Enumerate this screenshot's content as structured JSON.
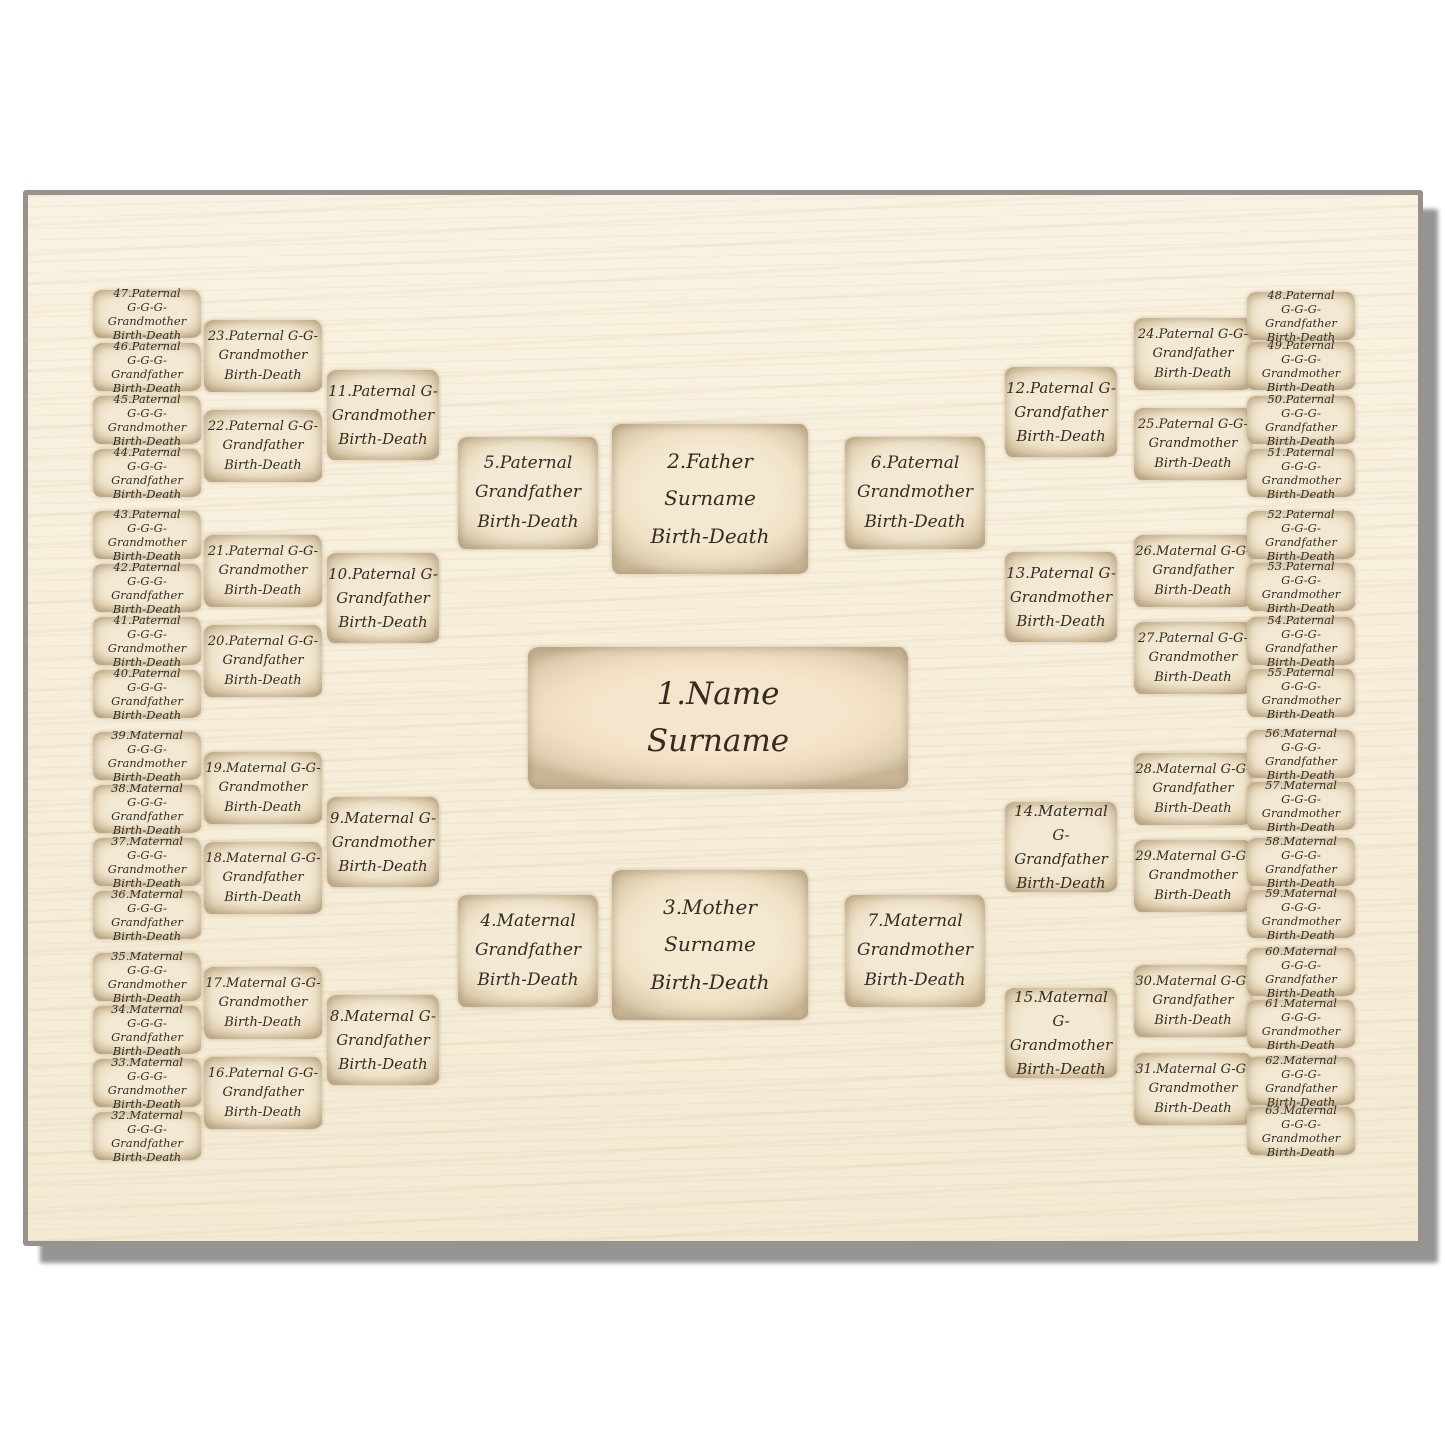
{
  "product": {
    "description": "6-generation genealogy family tree pedigree template printed on a wooden board",
    "colors": {
      "page_background": "#ffffff",
      "board_surface": "#f7efdc",
      "board_edge": "#97928c",
      "board_shadow": "#8f8f8f",
      "parchment_fill": "#f2e9d4",
      "parchment_edge": "#c8b696",
      "text": "#342c21"
    }
  },
  "boxes": {
    "1": {
      "l1": "1.Name",
      "l2": "Surname"
    },
    "2": {
      "l1": "2.Father",
      "l2": "Surname",
      "l3": "Birth-Death"
    },
    "3": {
      "l1": "3.Mother",
      "l2": "Surname",
      "l3": "Birth-Death"
    },
    "4": {
      "l1": "4.Maternal",
      "l2": "Grandfather",
      "l3": "Birth-Death"
    },
    "5": {
      "l1": "5.Paternal",
      "l2": "Grandfather",
      "l3": "Birth-Death"
    },
    "6": {
      "l1": "6.Paternal",
      "l2": "Grandmother",
      "l3": "Birth-Death"
    },
    "7": {
      "l1": "7.Maternal",
      "l2": "Grandmother",
      "l3": "Birth-Death"
    },
    "8": {
      "l1": "8.Maternal G-",
      "l2": "Grandfather",
      "l3": "Birth-Death"
    },
    "9": {
      "l1": "9.Maternal G-",
      "l2": "Grandmother",
      "l3": "Birth-Death"
    },
    "10": {
      "l1": "10.Paternal G-",
      "l2": "Grandfather",
      "l3": "Birth-Death"
    },
    "11": {
      "l1": "11.Paternal G-",
      "l2": "Grandmother",
      "l3": "Birth-Death"
    },
    "12": {
      "l1": "12.Paternal G-",
      "l2": "Grandfather",
      "l3": "Birth-Death"
    },
    "13": {
      "l1": "13.Paternal G-",
      "l2": "Grandmother",
      "l3": "Birth-Death"
    },
    "14": {
      "l1": "14.Maternal G-",
      "l2": "Grandfather",
      "l3": "Birth-Death"
    },
    "15": {
      "l1": "15.Maternal G-",
      "l2": "Grandmother",
      "l3": "Birth-Death"
    },
    "16": {
      "l1": "16.Paternal G-G-",
      "l2": "Grandfather",
      "l3": "Birth-Death"
    },
    "17": {
      "l1": "17.Maternal G-G-",
      "l2": "Grandmother",
      "l3": "Birth-Death"
    },
    "18": {
      "l1": "18.Maternal G-G-",
      "l2": "Grandfather",
      "l3": "Birth-Death"
    },
    "19": {
      "l1": "19.Maternal G-G-",
      "l2": "Grandmother",
      "l3": "Birth-Death"
    },
    "20": {
      "l1": "20.Paternal G-G-",
      "l2": "Grandfather",
      "l3": "Birth-Death"
    },
    "21": {
      "l1": "21.Paternal G-G-",
      "l2": "Grandmother",
      "l3": "Birth-Death"
    },
    "22": {
      "l1": "22.Paternal G-G-",
      "l2": "Grandfather",
      "l3": "Birth-Death"
    },
    "23": {
      "l1": "23.Paternal G-G-",
      "l2": "Grandmother",
      "l3": "Birth-Death"
    },
    "24": {
      "l1": "24.Paternal G-G-",
      "l2": "Grandfather",
      "l3": "Birth-Death"
    },
    "25": {
      "l1": "25.Paternal G-G-",
      "l2": "Grandmother",
      "l3": "Birth-Death"
    },
    "26": {
      "l1": "26.Maternal G-G-",
      "l2": "Grandfather",
      "l3": "Birth-Death"
    },
    "27": {
      "l1": "27.Paternal G-G-",
      "l2": "Grandmother",
      "l3": "Birth-Death"
    },
    "28": {
      "l1": "28.Maternal G-G-",
      "l2": "Grandfather",
      "l3": "Birth-Death"
    },
    "29": {
      "l1": "29.Maternal G-G-",
      "l2": "Grandmother",
      "l3": "Birth-Death"
    },
    "30": {
      "l1": "30.Maternal G-G-",
      "l2": "Grandfather",
      "l3": "Birth-Death"
    },
    "31": {
      "l1": "31.Maternal G-G-",
      "l2": "Grandmother",
      "l3": "Birth-Death"
    },
    "32": {
      "l1": "32.Maternal",
      "l2": "G-G-G-Grandfather",
      "l3": "Birth-Death"
    },
    "33": {
      "l1": "33.Maternal",
      "l2": "G-G-G-Grandmother",
      "l3": "Birth-Death"
    },
    "34": {
      "l1": "34.Maternal",
      "l2": "G-G-G-Grandfather",
      "l3": "Birth-Death"
    },
    "35": {
      "l1": "35.Maternal",
      "l2": "G-G-G-Grandmother",
      "l3": "Birth-Death"
    },
    "36": {
      "l1": "36.Maternal",
      "l2": "G-G-G-Grandfather",
      "l3": "Birth-Death"
    },
    "37": {
      "l1": "37.Maternal",
      "l2": "G-G-G-Grandmother",
      "l3": "Birth-Death"
    },
    "38": {
      "l1": "38.Maternal",
      "l2": "G-G-G-Grandfather",
      "l3": "Birth-Death"
    },
    "39": {
      "l1": "39.Maternal",
      "l2": "G-G-G-Grandmother",
      "l3": "Birth-Death"
    },
    "40": {
      "l1": "40.Paternal",
      "l2": "G-G-G-Grandfather",
      "l3": "Birth-Death"
    },
    "41": {
      "l1": "41.Paternal",
      "l2": "G-G-G-Grandmother",
      "l3": "Birth-Death"
    },
    "42": {
      "l1": "42.Paternal",
      "l2": "G-G-G-Grandfather",
      "l3": "Birth-Death"
    },
    "43": {
      "l1": "43.Paternal",
      "l2": "G-G-G-Grandmother",
      "l3": "Birth-Death"
    },
    "44": {
      "l1": "44.Paternal",
      "l2": "G-G-G-Grandfather",
      "l3": "Birth-Death"
    },
    "45": {
      "l1": "45.Paternal",
      "l2": "G-G-G-Grandmother",
      "l3": "Birth-Death"
    },
    "46": {
      "l1": "46.Paternal",
      "l2": "G-G-G-Grandfather",
      "l3": "Birth-Death"
    },
    "47": {
      "l1": "47.Paternal",
      "l2": "G-G-G-Grandmother",
      "l3": "Birth-Death"
    },
    "48": {
      "l1": "48.Paternal",
      "l2": "G-G-G-Grandfather",
      "l3": "Birth-Death"
    },
    "49": {
      "l1": "49.Paternal",
      "l2": "G-G-G-Grandmother",
      "l3": "Birth-Death"
    },
    "50": {
      "l1": "50.Paternal",
      "l2": "G-G-G-Grandfather",
      "l3": "Birth-Death"
    },
    "51": {
      "l1": "51.Paternal",
      "l2": "G-G-G-Grandmother",
      "l3": "Birth-Death"
    },
    "52": {
      "l1": "52.Paternal",
      "l2": "G-G-G-Grandfather",
      "l3": "Birth-Death"
    },
    "53": {
      "l1": "53.Paternal",
      "l2": "G-G-G-Grandmother",
      "l3": "Birth-Death"
    },
    "54": {
      "l1": "54.Paternal",
      "l2": "G-G-G-Grandfather",
      "l3": "Birth-Death"
    },
    "55": {
      "l1": "55.Paternal",
      "l2": "G-G-G-Grandmother",
      "l3": "Birth-Death"
    },
    "56": {
      "l1": "56.Maternal",
      "l2": "G-G-G-Grandfather",
      "l3": "Birth-Death"
    },
    "57": {
      "l1": "57.Maternal",
      "l2": "G-G-G-Grandmother",
      "l3": "Birth-Death"
    },
    "58": {
      "l1": "58.Maternal",
      "l2": "G-G-G-Grandfather",
      "l3": "Birth-Death"
    },
    "59": {
      "l1": "59.Maternal",
      "l2": "G-G-G-Grandmother",
      "l3": "Birth-Death"
    },
    "60": {
      "l1": "60.Maternal",
      "l2": "G-G-G-Grandfather",
      "l3": "Birth-Death"
    },
    "61": {
      "l1": "61.Maternal",
      "l2": "G-G-G-Grandmother",
      "l3": "Birth-Death"
    },
    "62": {
      "l1": "62.Maternal",
      "l2": "G-G-G-Grandfather",
      "l3": "Birth-Death"
    },
    "63": {
      "l1": "63.Maternal",
      "l2": "G-G-G-Grandmother",
      "l3": "Birth-Death"
    }
  }
}
